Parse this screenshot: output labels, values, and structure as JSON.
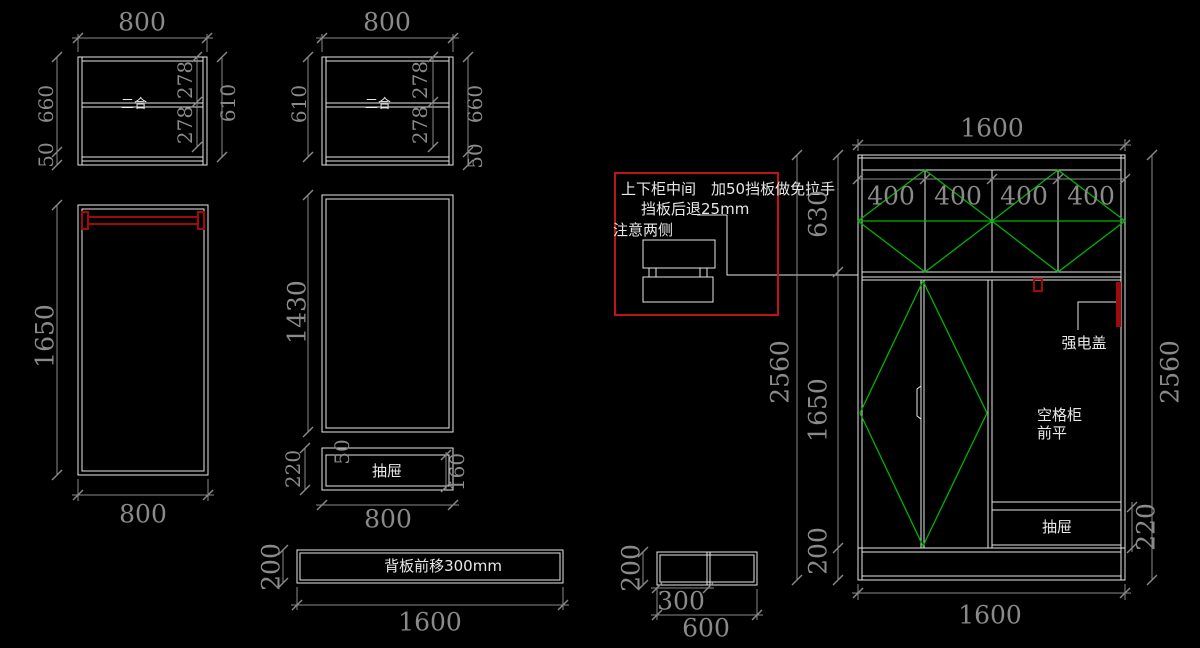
{
  "colors": {
    "background": "#000000",
    "line": "#e6e6e6",
    "dimension": "#8a8a8a",
    "door_mark_green": "#00b300",
    "annotation_red": "#c01414",
    "rod_red": "#9e0b0b"
  },
  "views": {
    "upper_cabinet_a": {
      "width_top": "800",
      "left_chain": [
        "660",
        "50"
      ],
      "right_inner": [
        "278",
        "278"
      ],
      "right_outer": "610",
      "center_label": "二合"
    },
    "upper_cabinet_b": {
      "width_top": "800",
      "left": "610",
      "right_inner": [
        "278",
        "278"
      ],
      "right_outer": [
        "660",
        "50"
      ],
      "center_label": "二合"
    },
    "tall_cabinet_a": {
      "height": "1650",
      "width_bottom": "800"
    },
    "tall_cabinet_b": {
      "height": "1430",
      "drawer_height": "220",
      "drawer_gap": "50",
      "drawer_front": "160",
      "drawer_label": "抽屉",
      "width_bottom": "800"
    },
    "back_panel": {
      "height": "200",
      "label": "背板前移300mm",
      "width_bottom": "1600"
    },
    "note_box": {
      "line1": "上下柜中间　加50挡板做免拉手",
      "line2": "挡板后退25mm",
      "line3": "注意两侧"
    },
    "small_cabinet": {
      "height": "200",
      "width_left": "300",
      "width_total": "600"
    },
    "main_cabinet": {
      "width_top": "1600",
      "columns": [
        "400",
        "400",
        "400",
        "400"
      ],
      "upper_height": "630",
      "middle_height": "1650",
      "base_height": "200",
      "height_total_left": "2560",
      "height_total_right": "2560",
      "drawer_height": "220",
      "power_label": "强电盖",
      "open_label_1": "空格柜",
      "open_label_2": "前平",
      "drawer_label": "抽屉",
      "width_bottom": "1600"
    }
  }
}
